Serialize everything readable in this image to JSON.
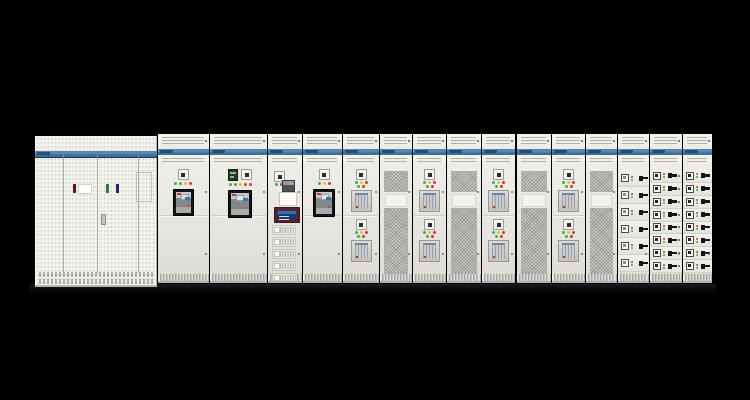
{
  "scene": {
    "type": "photograph",
    "subject": "Front view of a low-voltage switchgear / switchboard lineup of 16 cabinets on a black background",
    "background_color": "#000000"
  },
  "palette": {
    "cabinet_body": "#eceae4",
    "brand_band": "#5688b4",
    "brand_band_dark": "#1d3a5c",
    "brand_blob": "#24486e",
    "led_green": "#3fae4d",
    "led_yellow": "#e3c32f",
    "led_red": "#d23a2e",
    "breaker_frame": "#141518",
    "mesh": "#c9ccc6",
    "hmi_bezel": "#5d2027",
    "hmi_screen": "#1c3a6e",
    "handle_black": "#151515",
    "bar_maroon": "#5a1a20",
    "bar_green": "#2f7a3c",
    "bar_navy": "#1e2a6e"
  },
  "lineup": {
    "cabinet_count": 16,
    "brand_label": "",
    "hmi_module_stack": 5,
    "cabinets": [
      {
        "name": "main-switchboard",
        "kind": "perforated-triple-door"
      },
      {
        "name": "acb-section-1",
        "kind": "air-circuit-breaker"
      },
      {
        "name": "acb-section-2",
        "kind": "air-circuit-breaker-with-meter"
      },
      {
        "name": "control-hmi-section",
        "kind": "hmi-control"
      },
      {
        "name": "acb-section-3",
        "kind": "air-circuit-breaker"
      },
      {
        "name": "mccb-section-1",
        "kind": "double-mccb"
      },
      {
        "name": "mesh-door-1",
        "kind": "ventilated-mesh"
      },
      {
        "name": "mccb-section-2",
        "kind": "double-mccb"
      },
      {
        "name": "mesh-door-2",
        "kind": "ventilated-mesh"
      },
      {
        "name": "mccb-section-3",
        "kind": "double-mccb"
      },
      {
        "name": "mesh-door-3",
        "kind": "ventilated-mesh"
      },
      {
        "name": "mccb-section-4",
        "kind": "double-mccb"
      },
      {
        "name": "mesh-door-4",
        "kind": "ventilated-mesh"
      },
      {
        "name": "feeder-column-1",
        "kind": "feeder-switches",
        "rows": 6
      },
      {
        "name": "feeder-column-2",
        "kind": "feeder-switches",
        "rows": 8
      },
      {
        "name": "feeder-column-3",
        "kind": "feeder-switches",
        "rows": 8
      }
    ]
  }
}
